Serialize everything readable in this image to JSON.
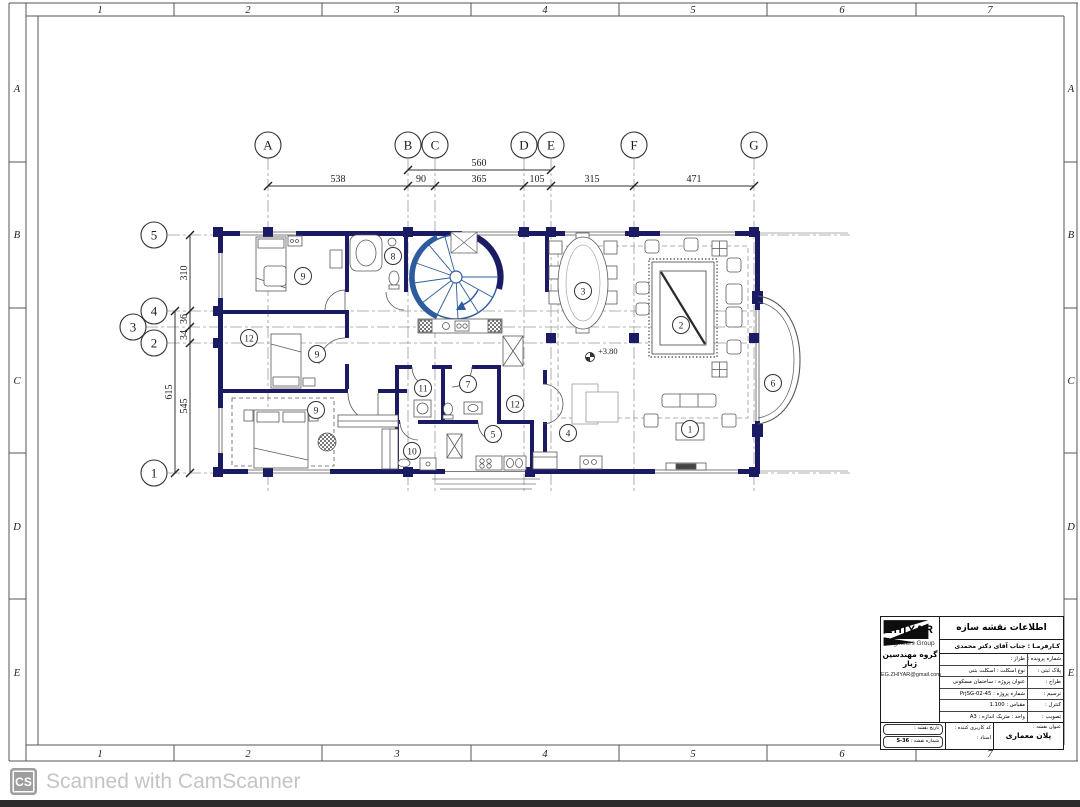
{
  "frame": {
    "cols": [
      "1",
      "2",
      "3",
      "4",
      "5",
      "6",
      "7"
    ],
    "rows": [
      "A",
      "B",
      "C",
      "D",
      "E"
    ]
  },
  "grid": {
    "top_bubbles": [
      "A",
      "B",
      "C",
      "D",
      "E",
      "F",
      "G"
    ],
    "left_bubbles": [
      "5",
      "4",
      "3",
      "2",
      "1"
    ],
    "dims_top": [
      "538",
      "90",
      "365",
      "105",
      "315",
      "471"
    ],
    "dim_top_overall": "560",
    "dims_left": [
      "310",
      "36",
      "34",
      "545"
    ],
    "dim_left_total": "615"
  },
  "plan": {
    "level_mark": "+3.80",
    "room_numbers": [
      "9",
      "8",
      "12",
      "9",
      "9",
      "11",
      "7",
      "12",
      "5",
      "10",
      "4",
      "3",
      "2",
      "1",
      "6"
    ]
  },
  "colors": {
    "wall_navy": "#1b1b63",
    "stair_blue": "#2d5c9e",
    "watermark_gray": "#c4c4c4"
  },
  "titleblock": {
    "header": "اطلاعات نقشه سازه",
    "client": "کـارفرمـا : جناب آقای دکتر محمدی",
    "rows_right": [
      "شماره پرونده :",
      "پلاک ثبتی :",
      "طراح :",
      "ترسیم :",
      "کنترل :",
      "تصویب :"
    ],
    "rows_left": [
      "طراز :",
      "نوع اسکلت : اسکلت بتنی",
      "عنوان پروژه : ساختمان مسکونی",
      "شماره پروژه : PrjSG-02-45",
      "مقیاس : 1.100",
      "واحد : متریک    اندازه : A3"
    ],
    "sheet_title_label": "عنوان نقشه :",
    "sheet_title": "پلان معماری",
    "user_code_label": "کد کاربری کننده :",
    "doc_label": "اسناد :",
    "date_label": "تاریخ نقشه :",
    "sheet_no_label": "شماره نقشه :",
    "sheet_no": "S-36",
    "logo": {
      "name": "ZHIYAR",
      "subtitle": "Engineers Group",
      "persian": "گروه مهندسین ژیار",
      "email": "EG.ZHIYAR@gmail.com"
    }
  },
  "watermark": {
    "icon_text": "CS",
    "text": "Scanned with CamScanner"
  }
}
